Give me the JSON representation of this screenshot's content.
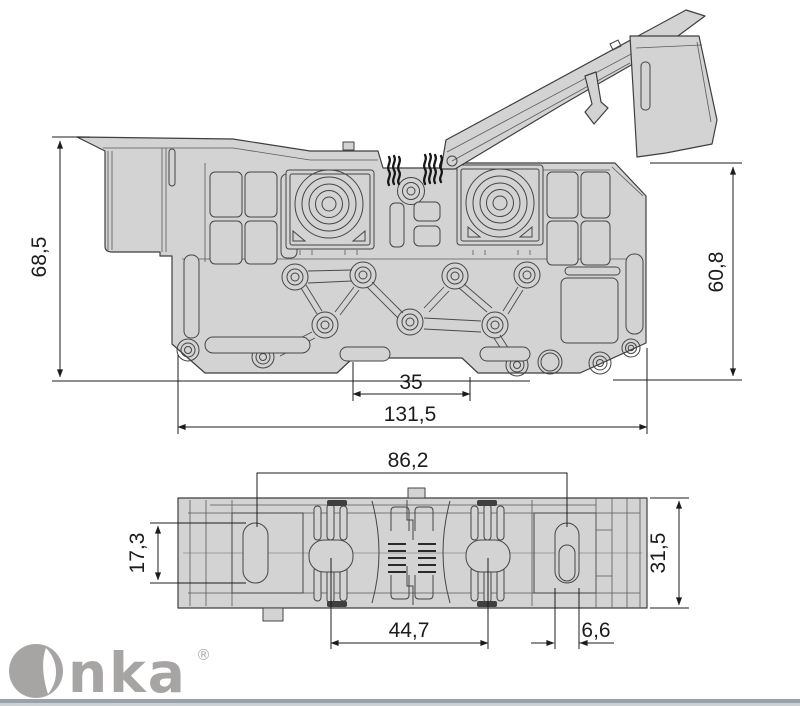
{
  "drawing": {
    "brand": {
      "name": "Onka",
      "name_tail": "nka",
      "registered": "®"
    },
    "front_view": {
      "dimensions": {
        "overall_height": "68,5",
        "body_height": "60,8",
        "din_notch_width": "35",
        "overall_width": "131,5"
      }
    },
    "top_view": {
      "dimensions": {
        "mount_slot_span": "86,2",
        "slot_length": "17,3",
        "overall_depth": "31,5",
        "contact_span": "44,7",
        "slot_width": "6,6"
      }
    },
    "colors": {
      "part_fill": "#d3d3d3",
      "outline": "#3f3f3f",
      "dimension": "#1c1c1c",
      "logo": "#a7a4a4",
      "footer_bar": "#99a1a9",
      "background": "#ffffff"
    }
  }
}
